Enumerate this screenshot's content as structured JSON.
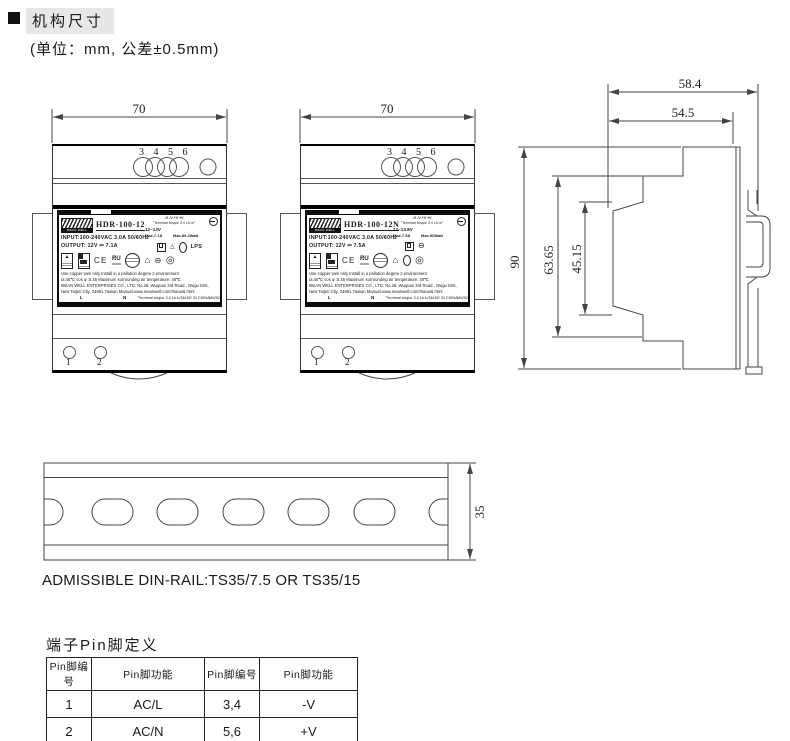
{
  "header": {
    "section_title": "机构尺寸",
    "unit_note": "(单位：mm, 公差±0.5mm)"
  },
  "front_views": {
    "width_dim": "70",
    "top_pin_numbers": "3 4 5 6",
    "bottom_pin_1": "1",
    "bottom_pin_2": "2"
  },
  "units": [
    {
      "model": "HDR-100-12",
      "brand": "MEAN WELL",
      "polarity_row": "-V   -V   +V   +V",
      "torque_top": "\"Terminal torque 4.4 Lb-in\"",
      "voltage_range": "12~13V",
      "max_current": "Max.7.1A",
      "max_power": "Max.85.2Watt",
      "input_line": "INPUT:100-240VAC  3.0A  50/60Hz",
      "output_line": "OUTPUT: 12V ⎓ 7.1A",
      "ce_mark": "CE",
      "lps_mark": "LPS",
      "note_line1": "Use copper wire only      Install in a  pollution degree 2 environment",
      "note_line2": "ta:45℃    cos φ :0.45      Maximum surrounding air temperature: 45℃",
      "company_line1": "MEAN WELL ENTERPRISES CO., LTD.   No.28, Wuquan 3rd Road., Wugu Dist.,",
      "company_line2": "New Taipei City, 24891,Taiwan    Manual:www.meanwell.com/manual.html",
      "terminal_l": "L",
      "terminal_n": "N",
      "torque_bottom": "\"Terminal torque 3.0 Lb-in\"",
      "made_in": "MADE IN CHINA",
      "label_code": "MW92"
    },
    {
      "model": "HDR-100-12N",
      "brand": "MEAN WELL",
      "polarity_row": "-V   -V   +V   +V",
      "torque_top": "\"Terminal torque 4.4 Lb-in\"",
      "voltage_range": "12~13.8V",
      "max_current": "Max.7.5A",
      "max_power": "Max.90Watt",
      "input_line": "INPUT:100-240VAC  3.0A  50/60Hz",
      "output_line": "OUTPUT: 12V ⎓ 7.5A",
      "ce_mark": "CE",
      "lps_mark": "",
      "note_line1": "Use copper wire only      Install in a  pollution degree 2 environment",
      "note_line2": "ta:40℃    cos φ :0.45      Maximum surrounding air temperature: 40℃",
      "company_line1": "MEAN WELL ENTERPRISES CO., LTD.   No.28, Wuquan 3rd Road., Wugu Dist.,",
      "company_line2": "New Taipei City, 24891,Taiwan    Manual:www.meanwell.com/manual.html",
      "terminal_l": "L",
      "terminal_n": "N",
      "torque_bottom": "\"Terminal torque 3.0 Lb-in\"",
      "made_in": "MADE IN CHINA",
      "label_code": "MW92"
    }
  ],
  "side_view": {
    "dim_total_depth": "58.4",
    "dim_body_depth": "54.5",
    "dim_height": "90",
    "dim_step_height": "63.65",
    "dim_face_height": "45.15"
  },
  "din_rail": {
    "dim_height": "35",
    "caption": "ADMISSIBLE DIN-RAIL:TS35/7.5 OR TS35/15"
  },
  "pin_table": {
    "title": "端子Pin脚定义",
    "headers": [
      "Pin脚编号",
      "Pin脚功能",
      "Pin脚编号",
      "Pin脚功能"
    ],
    "rows": [
      [
        "1",
        "AC/L",
        "3,4",
        "-V"
      ],
      [
        "2",
        "AC/N",
        "5,6",
        "+V"
      ]
    ]
  },
  "icons": {
    "house": "⌂",
    "dc_circle": "⊖",
    "spiral": "◎",
    "warning_triangle": "▲",
    "recycle_triangle": "△",
    "ru_mark": "RU"
  }
}
